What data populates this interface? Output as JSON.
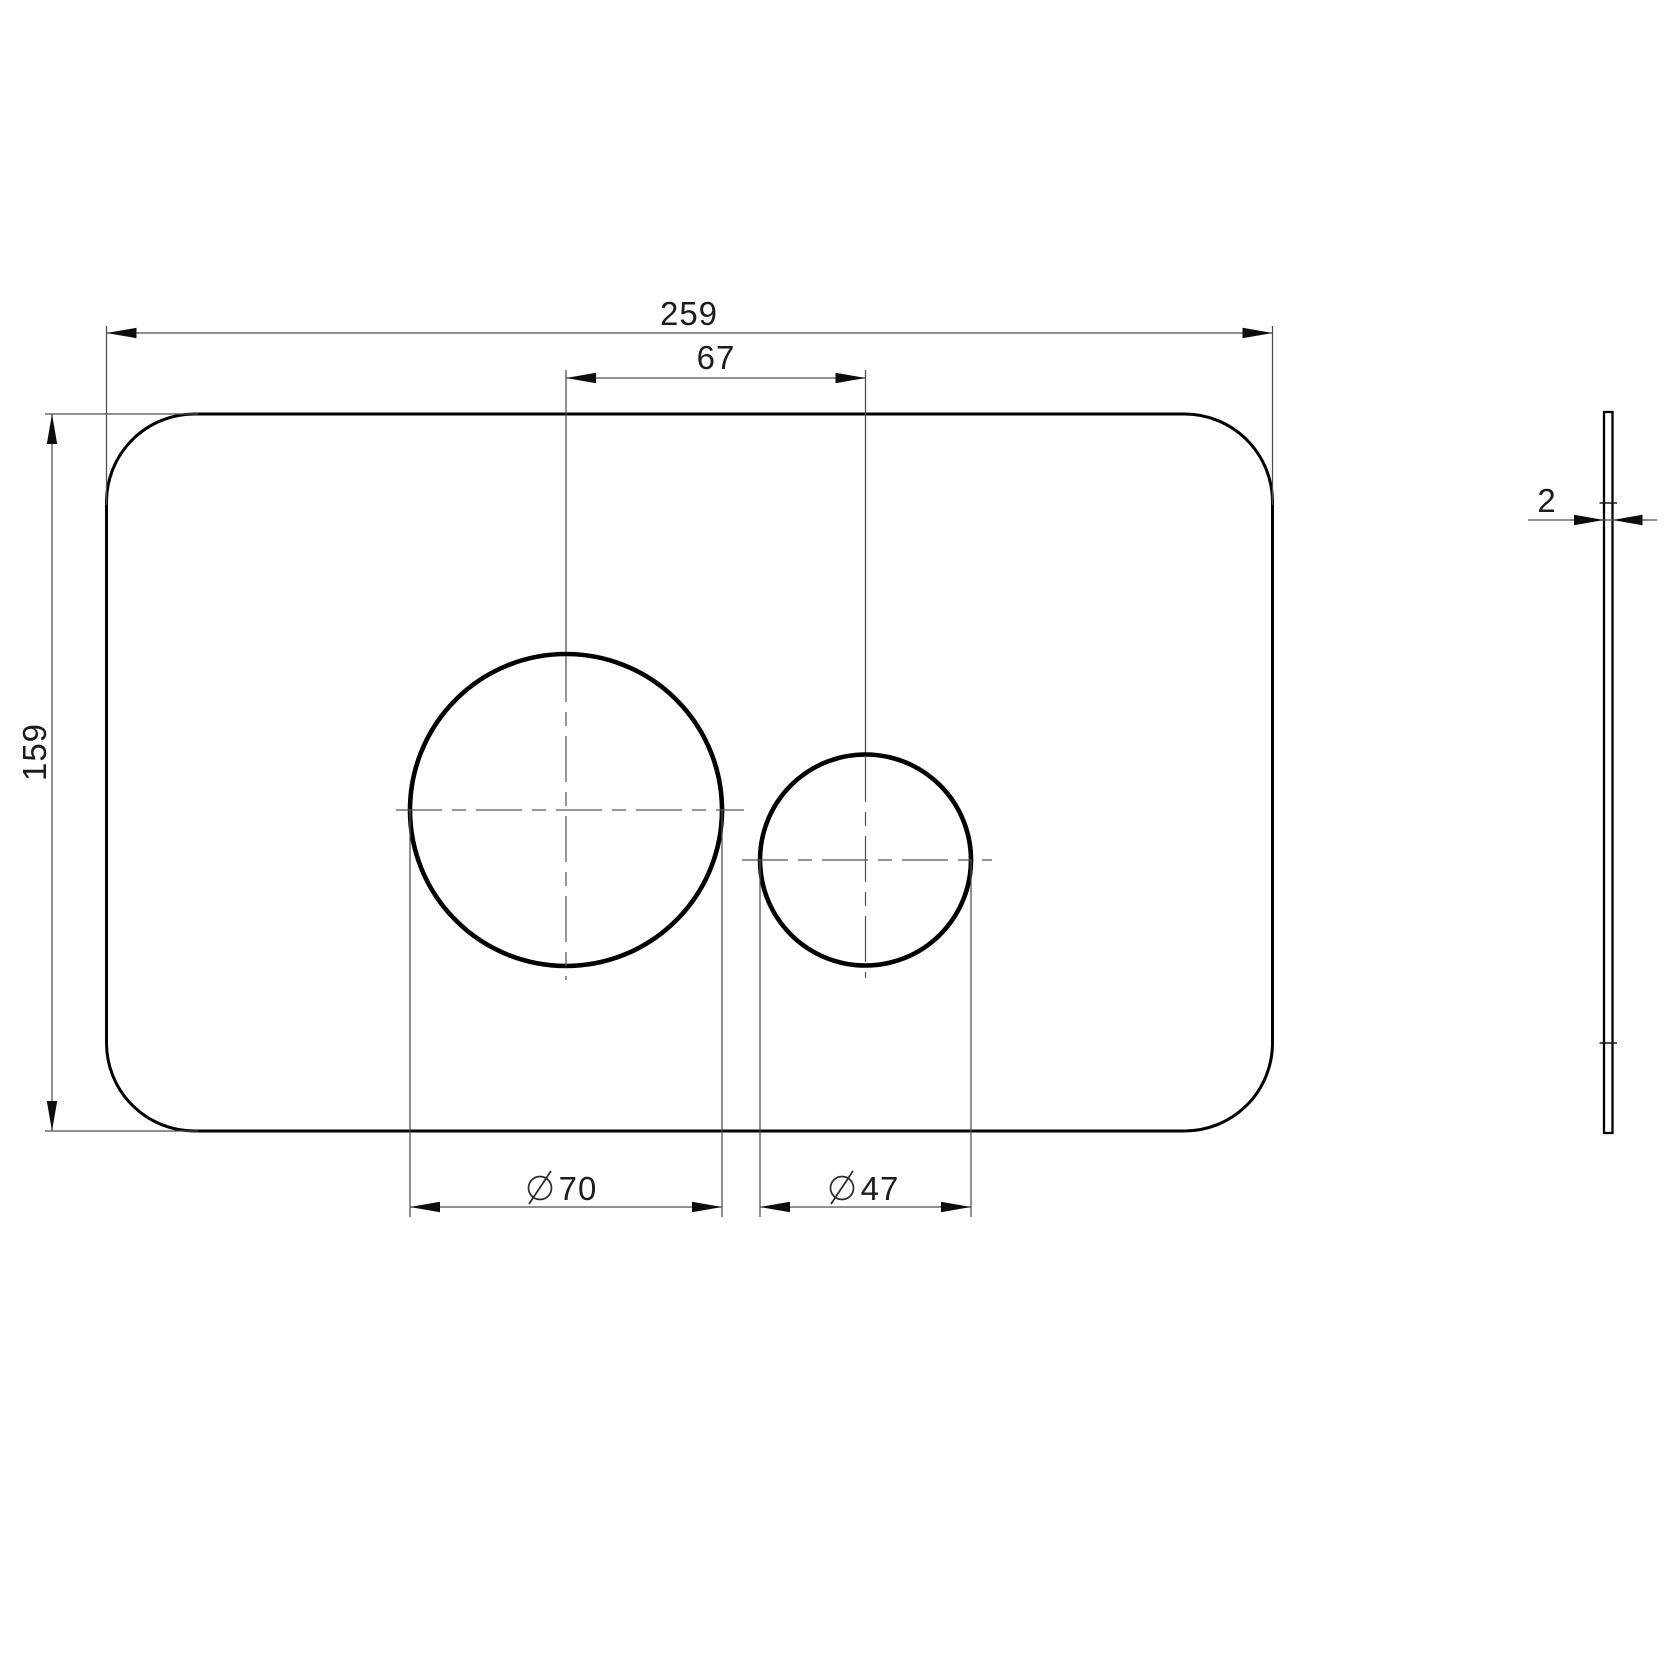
{
  "drawing": {
    "diameter_symbol": "Ø",
    "dimensions": {
      "overall_width": {
        "label": "259",
        "value": 259
      },
      "hole_center_spacing": {
        "label": "67",
        "value": 67
      },
      "overall_height": {
        "label": "159",
        "value": 159
      },
      "large_hole_diameter": {
        "label": "70",
        "value": 70,
        "symbol": "Ø"
      },
      "small_hole_diameter": {
        "label": "47",
        "value": 47,
        "symbol": "Ø"
      },
      "thickness": {
        "label": "2",
        "value": 2
      }
    }
  }
}
